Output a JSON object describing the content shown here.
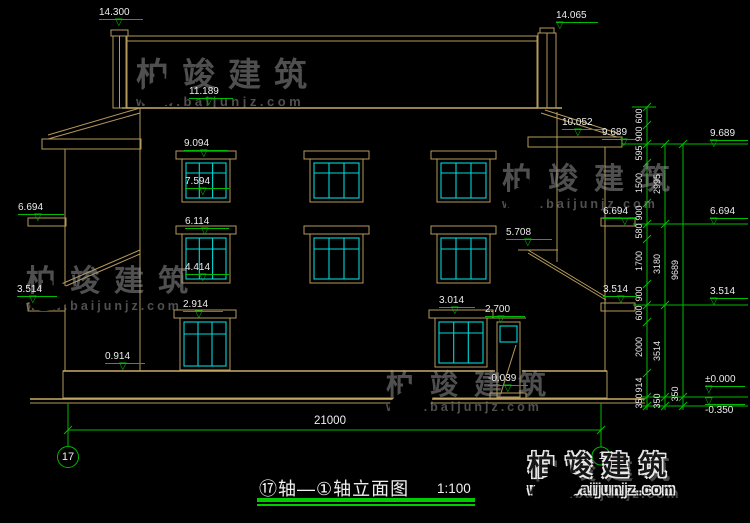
{
  "drawing": {
    "title": "⑰轴—①轴立面图",
    "scale": "1:100",
    "axis_left": "17",
    "axis_right": "1",
    "total_width_label": "21000"
  },
  "brand": {
    "name": "柏竣建筑",
    "url": "www.baijunjz.com"
  },
  "colors": {
    "line": "#b49a5a",
    "glass": "#00d8d8",
    "dim": "#00bb00",
    "text": "#ededed"
  },
  "elevations": [
    {
      "t": "14.300",
      "x": 99,
      "y": 8,
      "tp": 16,
      "w": 44
    },
    {
      "t": "14.065",
      "x": 556,
      "y": 11,
      "tp": 0,
      "w": 42
    },
    {
      "t": "11.189",
      "x": 189,
      "y": 87,
      "tp": 16,
      "w": 44
    },
    {
      "t": "10.052",
      "x": 562,
      "y": 118,
      "tp": 12,
      "w": 44
    },
    {
      "t": "9.689",
      "x": 602,
      "y": 128,
      "tp": 18,
      "w": 34
    },
    {
      "t": "9.689",
      "x": 710,
      "y": 129,
      "tp": 0,
      "w": 38
    },
    {
      "t": "9.094",
      "x": 184,
      "y": 139,
      "tp": 16,
      "w": 44
    },
    {
      "t": "7.594",
      "x": 185,
      "y": 177,
      "tp": 14,
      "w": 44
    },
    {
      "t": "6.694",
      "x": 18,
      "y": 203,
      "tp": 16,
      "w": 46
    },
    {
      "t": "6.114",
      "x": 185,
      "y": 217,
      "tp": 16,
      "w": 44
    },
    {
      "t": "6.694",
      "x": 603,
      "y": 207,
      "tp": 18,
      "w": 34
    },
    {
      "t": "6.694",
      "x": 710,
      "y": 207,
      "tp": 0,
      "w": 38
    },
    {
      "t": "5.708",
      "x": 506,
      "y": 228,
      "tp": 18,
      "w": 46
    },
    {
      "t": "4.414",
      "x": 185,
      "y": 263,
      "tp": 14,
      "w": 44
    },
    {
      "t": "3.514",
      "x": 17,
      "y": 285,
      "tp": 12,
      "w": 40
    },
    {
      "t": "3.514",
      "x": 603,
      "y": 285,
      "tp": 14,
      "w": 34
    },
    {
      "t": "3.514",
      "x": 710,
      "y": 287,
      "tp": 0,
      "w": 38
    },
    {
      "t": "3.014",
      "x": 439,
      "y": 296,
      "tp": 12,
      "w": 36
    },
    {
      "t": "2.914",
      "x": 183,
      "y": 300,
      "tp": 12,
      "w": 40
    },
    {
      "t": "2.700",
      "x": 485,
      "y": 305,
      "tp": 12,
      "w": 40
    },
    {
      "t": "0.914",
      "x": 105,
      "y": 352,
      "tp": 14,
      "w": 40
    },
    {
      "t": "-0.039",
      "x": 488,
      "y": 374,
      "tp": 16,
      "w": 40
    },
    {
      "t": "±0.000",
      "x": 705,
      "y": 375,
      "tp": 0,
      "w": 40
    },
    {
      "t": "-0.350",
      "x": 705,
      "y": 397,
      "tp": 0,
      "w": 40,
      "flip": true
    }
  ],
  "dim_chain": {
    "columns": [
      {
        "x": 647,
        "ticks": [
          107,
          125,
          144,
          163,
          203,
          224,
          239,
          284,
          305,
          322,
          373,
          397,
          406
        ],
        "labels": [
          [
            "600",
            116
          ],
          [
            "900",
            134
          ],
          [
            "595",
            153
          ],
          [
            "1500",
            183
          ],
          [
            "900",
            213
          ],
          [
            "580",
            231
          ],
          [
            "1700",
            261
          ],
          [
            "900",
            294
          ],
          [
            "600",
            313
          ],
          [
            "2000",
            347
          ],
          [
            "914",
            385
          ],
          [
            "350",
            401
          ]
        ]
      },
      {
        "x": 665,
        "ticks": [
          144,
          224,
          305,
          397,
          406
        ],
        "labels": [
          [
            "2995",
            184
          ],
          [
            "3180",
            264
          ],
          [
            "3514",
            351
          ],
          [
            "350",
            401
          ]
        ]
      },
      {
        "x": 683,
        "ticks": [
          144,
          397,
          406
        ],
        "labels": [
          [
            "9689",
            270
          ],
          [
            "350",
            394
          ]
        ]
      }
    ],
    "hlines": [
      [
        107,
        632,
        656
      ],
      [
        144,
        622,
        748
      ],
      [
        224,
        633,
        748
      ],
      [
        305,
        633,
        748
      ],
      [
        397,
        642,
        748
      ],
      [
        406,
        642,
        748
      ]
    ],
    "line_ticks": [
      [
        68,
        430
      ],
      [
        601,
        430
      ]
    ]
  }
}
